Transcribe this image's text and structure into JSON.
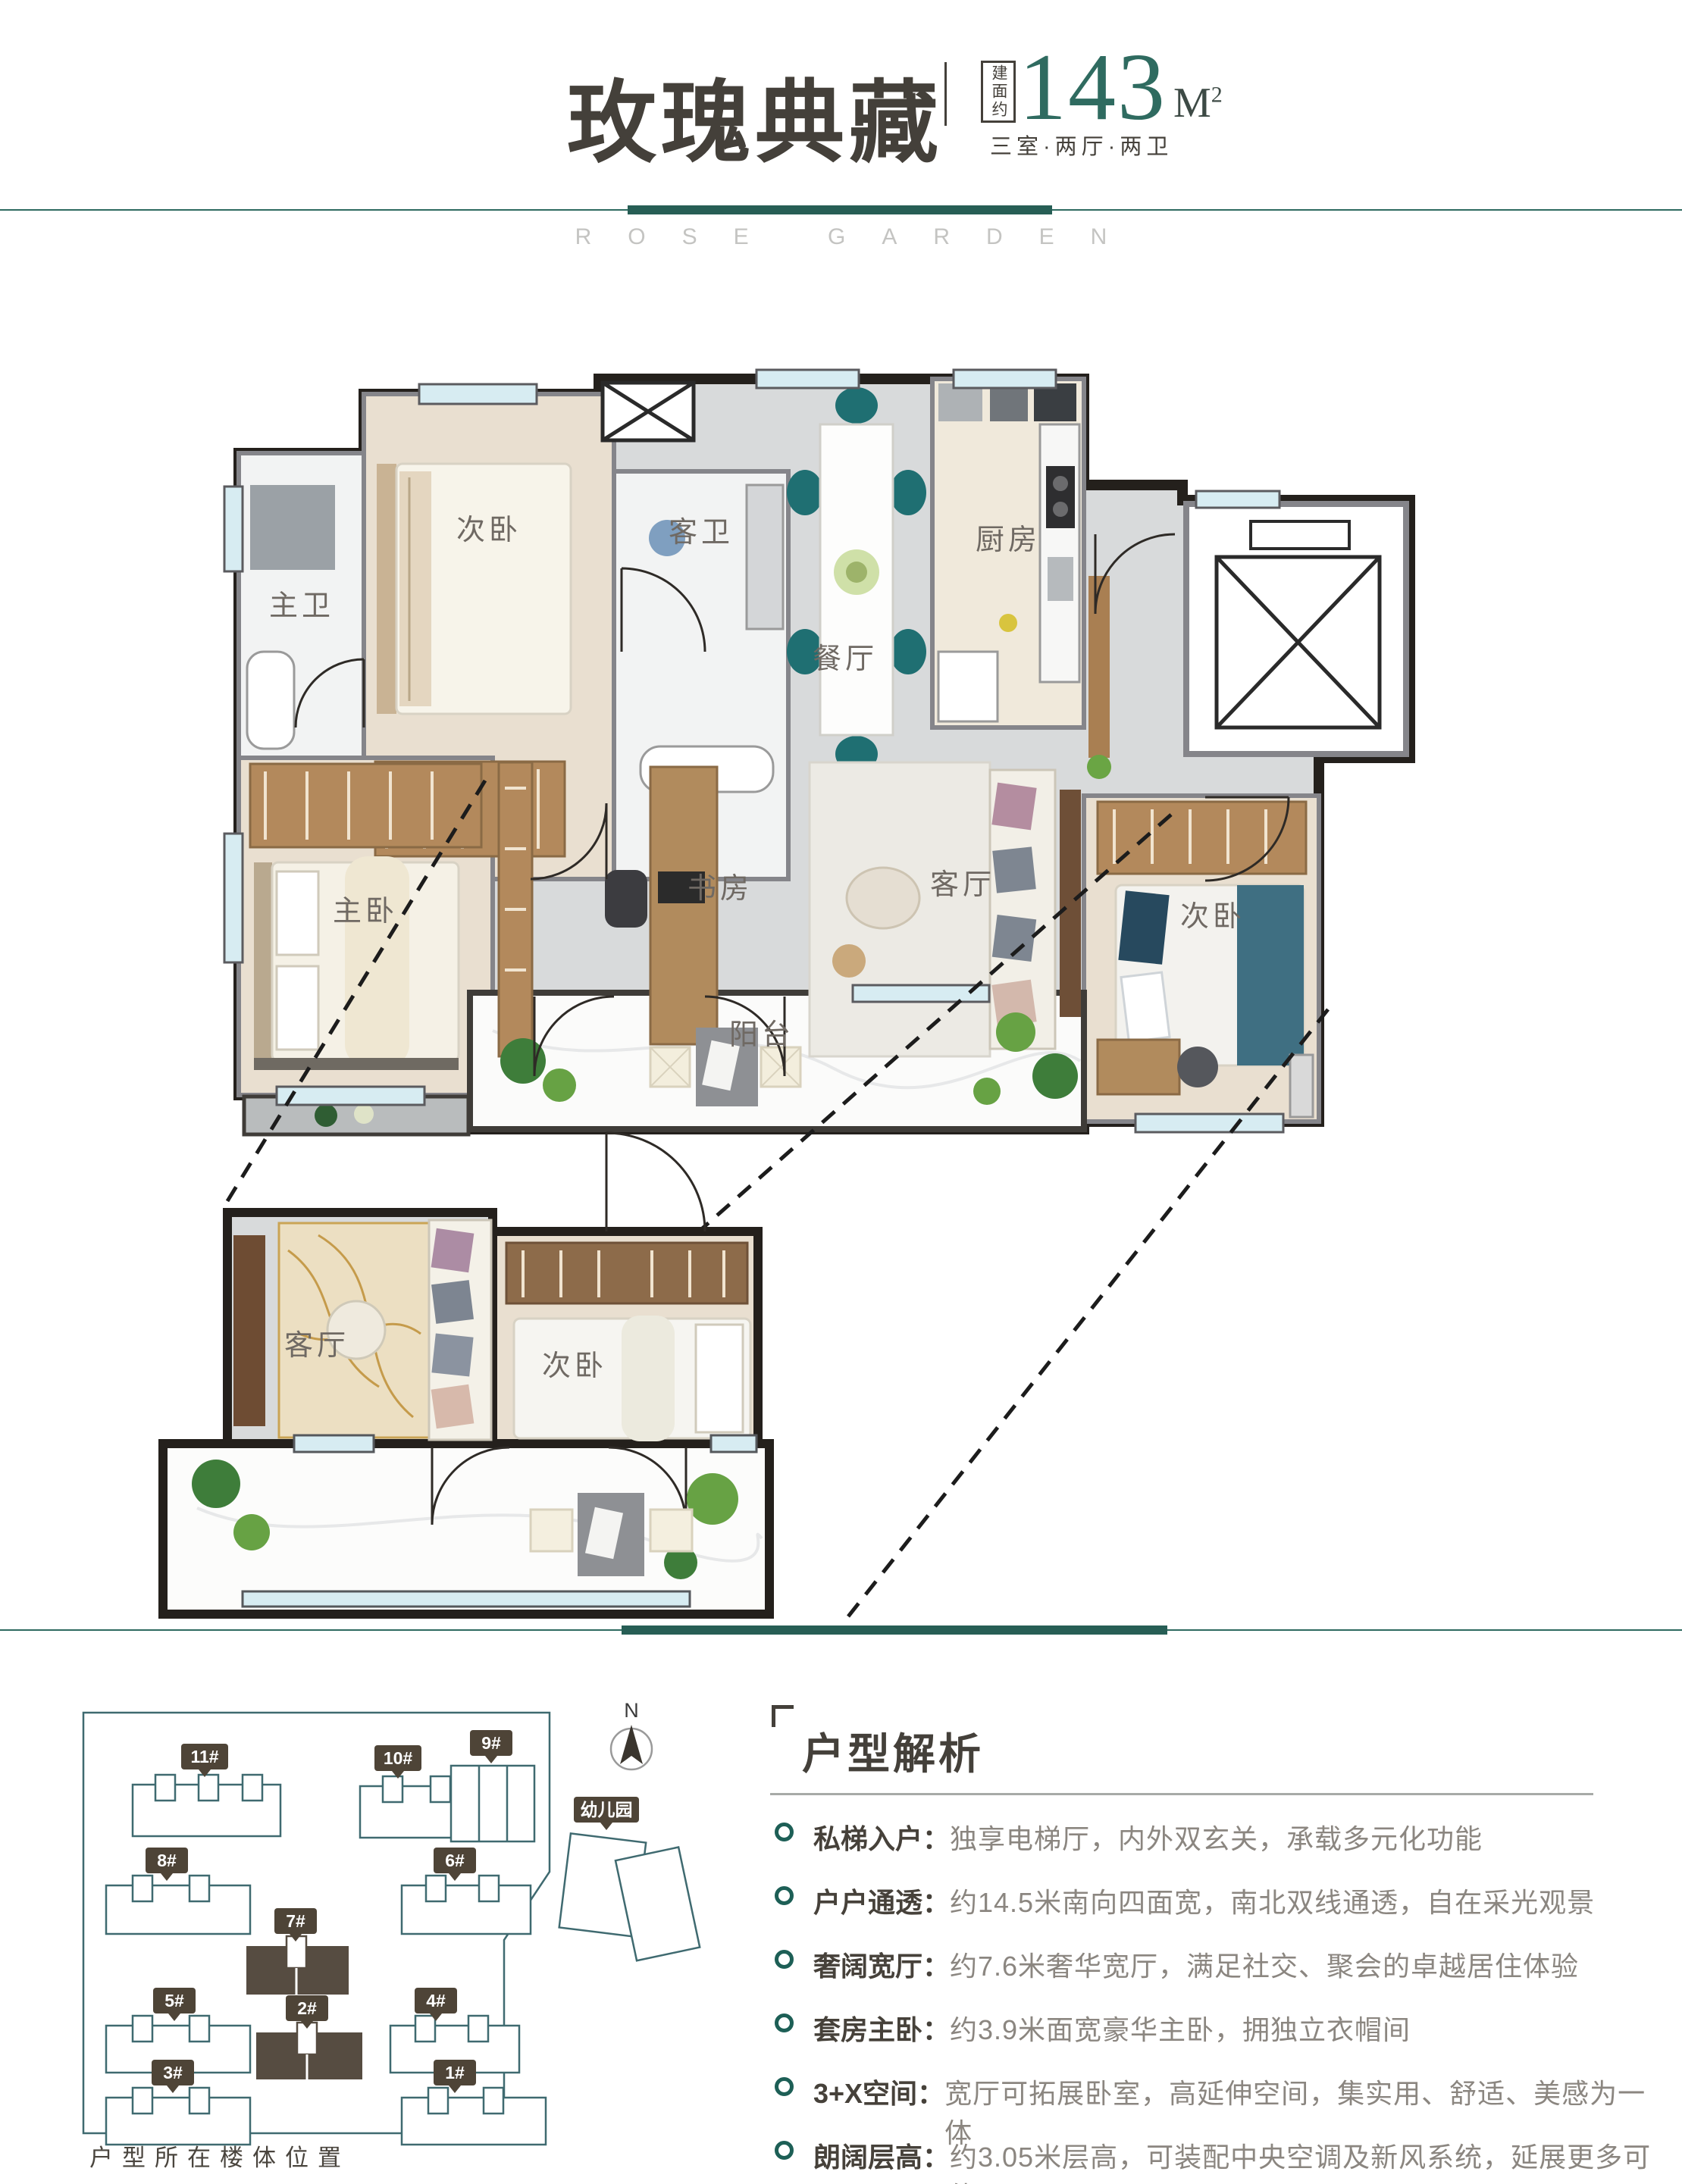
{
  "header": {
    "title": "玫瑰典藏",
    "area_label": "建面约",
    "area_value": "143",
    "area_unit": "M",
    "area_unit_sup": "2",
    "layout_spec": "三室·两厅·两卫"
  },
  "watermark": "ROSE GARDEN",
  "floor_plan": {
    "rooms": {
      "master_bath": "主卫",
      "bedroom_top": "次卧",
      "guest_bath": "客卫",
      "dining": "餐厅",
      "kitchen": "厨房",
      "master_bedroom": "主卧",
      "study": "书房",
      "living": "客厅",
      "bedroom_right": "次卧",
      "balcony": "阳台"
    }
  },
  "detail_plan": {
    "living": "客厅",
    "bedroom": "次卧"
  },
  "site_plan": {
    "buildings": [
      {
        "id": "11#"
      },
      {
        "id": "10#"
      },
      {
        "id": "9#"
      },
      {
        "id": "8#"
      },
      {
        "id": "6#"
      },
      {
        "id": "7#"
      },
      {
        "id": "5#"
      },
      {
        "id": "4#"
      },
      {
        "id": "2#"
      },
      {
        "id": "3#"
      },
      {
        "id": "1#"
      }
    ],
    "highlighted_buildings": [
      "7#",
      "2#"
    ],
    "kindergarten": "幼儿园",
    "compass_n": "N",
    "caption": "户型所在楼体位置"
  },
  "analysis": {
    "title": "户型解析",
    "items": [
      {
        "term": "私梯入户：",
        "desc": "独享电梯厅，内外双玄关，承载多元化功能"
      },
      {
        "term": "户户通透：",
        "desc": "约14.5米南向四面宽，南北双线通透，自在采光观景"
      },
      {
        "term": "奢阔宽厅：",
        "desc": "约7.6米奢华宽厅，满足社交、聚会的卓越居住体验"
      },
      {
        "term": "套房主卧：",
        "desc": "约3.9米面宽豪华主卧，拥独立衣帽间"
      },
      {
        "term": "3+X空间：",
        "desc": "宽厅可拓展卧室，高延伸空间，集实用、舒适、美感为一体"
      },
      {
        "term": "朗阔层高：",
        "desc": "约3.05米层高，可装配中央空调及新风系统，延展更多可能"
      }
    ]
  },
  "colors": {
    "accent_teal": "#2e6a60",
    "area_number": "#2f6b60",
    "title_dark": "#44403a",
    "text_gray": "#8b8680",
    "wall_dark": "#24201c",
    "highlight_building": "#564c41"
  }
}
